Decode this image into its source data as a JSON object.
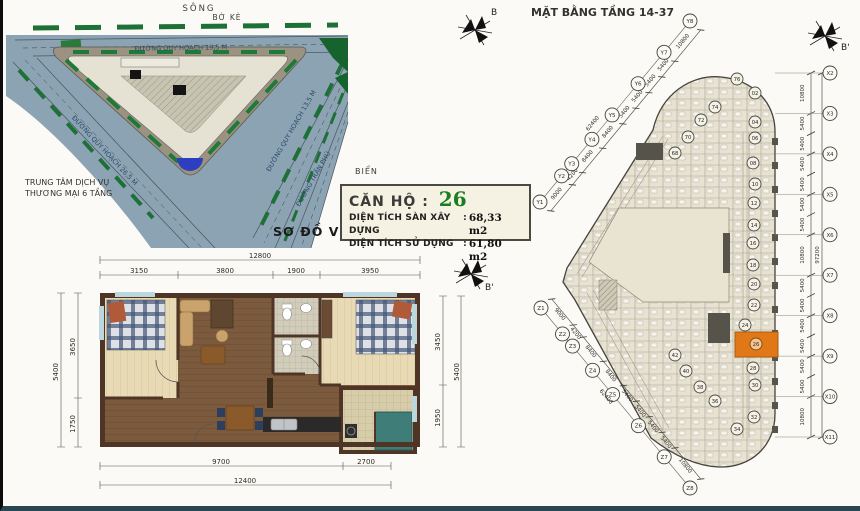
{
  "site_map": {
    "compass_label": "B",
    "labels": {
      "river": "SÔNG",
      "embankment": "BỜ KÈ",
      "road_top": "ĐƯỜNG QUY HOẠCH 19,5 M",
      "road_left": "ĐƯỜNG QUY HOẠCH 26,5 M",
      "road_right": "ĐƯỜNG QUY HOẠCH 13,5 M",
      "road_tran_phu": "ĐƯỜNG TRẦN PHÚ",
      "center_line1": "TRUNG TÂM DỊCH VỤ",
      "center_line2": "THƯƠNG MẠI 6 TẦNG",
      "sea": "BIỂN",
      "caption": "SƠ ĐỒ VỊ TRÍ"
    }
  },
  "info_box": {
    "title_label": "CĂN HỘ :",
    "unit_number": "26",
    "colon": ":",
    "rows": [
      {
        "label": "DIỆN TÍCH SÀN XÂY DỰNG",
        "value": "68,33 m2"
      },
      {
        "label": "DIỆN TÍCH SỬ DỤNG",
        "value": "61,80 m2"
      }
    ]
  },
  "apartment": {
    "compass_label": "B'",
    "top_total": "12800",
    "top_segments": [
      "3150",
      "3800",
      "1900",
      "3950"
    ],
    "left_segments": [
      "3650",
      "1750"
    ],
    "left_total": "5400",
    "right_segments": [
      "3450",
      "1950"
    ],
    "right_total": "5400",
    "bottom_segments": [
      "9700",
      "2700"
    ],
    "bottom_total": "12400"
  },
  "tower": {
    "title": "MẶT BẰNG TẦNG 14-37",
    "compass_label": "B'",
    "highlight_color": "#e07818",
    "highlighted_unit": "26",
    "y_axes": [
      "Y1",
      "Y2",
      "Y3",
      "Y4",
      "Y5",
      "Y6",
      "Y7",
      "Y8"
    ],
    "y_dims": [
      "9000",
      "4200",
      "8400",
      "8400",
      "5400",
      "5400",
      "5400",
      "5400",
      "10800"
    ],
    "y_total": "62400",
    "z_axes": [
      "Z1",
      "Z2",
      "Z3",
      "Z4",
      "Z5",
      "Z6",
      "Z7",
      "Z8"
    ],
    "z_dims": [
      "9000",
      "4200",
      "8400",
      "8400",
      "5400",
      "5400",
      "5400",
      "5400",
      "10800"
    ],
    "z_total": "62400",
    "x_axes": [
      "X2",
      "X3",
      "X4",
      "X5",
      "X6",
      "X7",
      "X8",
      "X9",
      "X10",
      "X11"
    ],
    "x_dims": [
      "10800",
      "5400",
      "5400",
      "5400",
      "5400",
      "5400",
      "5400",
      "10800",
      "5400",
      "5400",
      "5400",
      "5400",
      "5400",
      "5400",
      "10800"
    ],
    "x_total": "97200",
    "units": [
      "02",
      "04",
      "06",
      "08",
      "10",
      "12",
      "14",
      "16",
      "18",
      "20",
      "22",
      "24",
      "26",
      "28",
      "30",
      "32",
      "34",
      "36",
      "38",
      "40",
      "42",
      "68",
      "70",
      "72",
      "74",
      "76"
    ]
  }
}
